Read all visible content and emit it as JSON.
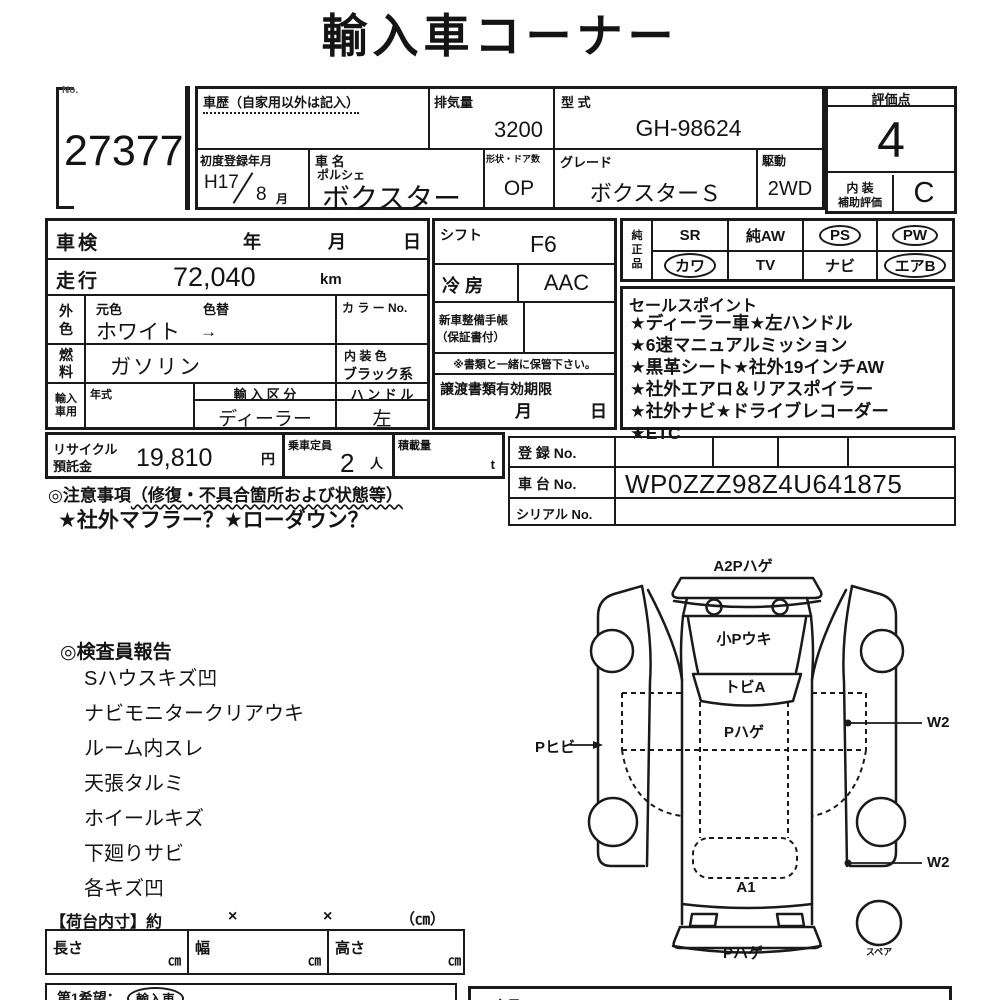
{
  "page_title": "輸入車コーナー",
  "lot": {
    "no_label": "No.",
    "number": "27377"
  },
  "header": {
    "history_label": "車歴（自家用以外は記入）",
    "displacement_label": "排気量",
    "displacement": "3200",
    "model_code_label": "型 式",
    "model_code": "GH-98624",
    "first_reg_label": "初度登録年月",
    "first_reg_year": "H17",
    "first_reg_month": "8",
    "month_unit": "月",
    "car_name_label": "車 名",
    "maker": "ポルシェ",
    "car_name": "ボクスター",
    "shape_label": "形状・ドア数",
    "shape": "OP",
    "grade_label": "グレード",
    "grade": "ボクスターＳ",
    "drive_label": "駆動",
    "drive": "2WD"
  },
  "evaluation": {
    "score_label": "評価点",
    "score": "4",
    "interior_label_1": "内 装",
    "interior_label_2": "補助評価",
    "interior_score": "C"
  },
  "left_panel": {
    "shaken_label": "車検",
    "year_label": "年",
    "month_label": "月",
    "day_label": "日",
    "mileage_label": "走行",
    "mileage": "72,040",
    "mileage_unit": "km",
    "ext_color_label": "外色",
    "orig_color_label": "元色",
    "color_change_label": "色替",
    "ext_color": "ホワイト",
    "arrow": "→",
    "color_no_label": "カ ラ ー No.",
    "fuel_label": "燃料",
    "fuel": "ガソリン",
    "interior_color_label": "内 装 色",
    "interior_color": "ブラック系",
    "import_label": "輸入車用",
    "year_model_label": "年式",
    "import_class_label": "輸 入 区 分",
    "import_class": "ディーラー",
    "handle_label": "ハ ン ド ル",
    "handle": "左"
  },
  "middle_panel": {
    "shift_label": "シフト",
    "shift": "F6",
    "ac_label": "冷 房",
    "ac": "AAC",
    "book_label_1": "新車整備手帳",
    "book_label_2": "（保証書付）",
    "keep_note": "※書類と一緒に保管下さい。",
    "transfer_label": "譲渡書類有効期限",
    "month_label": "月",
    "day_label": "日"
  },
  "equipment": {
    "label": "純正品",
    "row1": [
      {
        "label": "SR",
        "circled": false
      },
      {
        "label": "純AW",
        "circled": false
      },
      {
        "label": "PS",
        "circled": true
      },
      {
        "label": "PW",
        "circled": true
      }
    ],
    "row2": [
      {
        "label": "カワ",
        "circled": true
      },
      {
        "label": "TV",
        "circled": false
      },
      {
        "label": "ナビ",
        "circled": false
      },
      {
        "label": "エアB",
        "circled": true
      }
    ]
  },
  "sales_points": {
    "label": "セールスポイント",
    "lines": [
      "★ディーラー車★左ハンドル",
      "★6速マニュアルミッション",
      "★黒革シート★社外19インチAW",
      "★社外エアロ＆リアスポイラー",
      "★社外ナビ★ドライブレコーダー",
      "★ETC"
    ]
  },
  "recycle": {
    "label_1": "リサイクル",
    "label_2": "預託金",
    "amount": "19,810",
    "yen": "円",
    "capacity_label": "乗車定員",
    "capacity": "2",
    "capacity_unit": "人",
    "load_label": "積載量",
    "load_unit": "t"
  },
  "registration": {
    "reg_label": "登 録 No.",
    "chassis_label": "車 台 No.",
    "chassis": "WP0ZZZ98Z4U641875",
    "serial_label": "シリアル No."
  },
  "cautions": {
    "heading": "◎注意事項",
    "paren": "（修復・不具合箇所および状態等）",
    "line": "★社外マフラー？★ローダウン？"
  },
  "inspector": {
    "label": "◎検査員報告",
    "items": [
      "Sハウスキズ凹",
      "ナビモニタークリアウキ",
      "ルーム内スレ",
      "天張タルミ",
      "ホイールキズ",
      "下廻りサビ",
      "各キズ凹"
    ]
  },
  "diagram": {
    "front_label": "A2Pハゲ",
    "hood_label": "小Pウキ",
    "windshield_label": "トビA",
    "roof_label": "Pハゲ",
    "left_side_label": "Pヒビ",
    "w2_label": "W2",
    "rear_window_label": "A1",
    "rear_label": "Pハゲ",
    "spare_label": "スペア"
  },
  "cargo": {
    "label": "【荷台内寸】約",
    "times": "×",
    "unit": "（㎝）",
    "length_label": "長さ",
    "width_label": "幅",
    "height_label": "高さ",
    "cm": "㎝"
  },
  "footer": {
    "first_choice_label": "第1希望：",
    "first_choice_value": "輸入車",
    "member_label": "会員No."
  },
  "colors": {
    "ink": "#1a1a1a",
    "paper": "#ffffff"
  }
}
